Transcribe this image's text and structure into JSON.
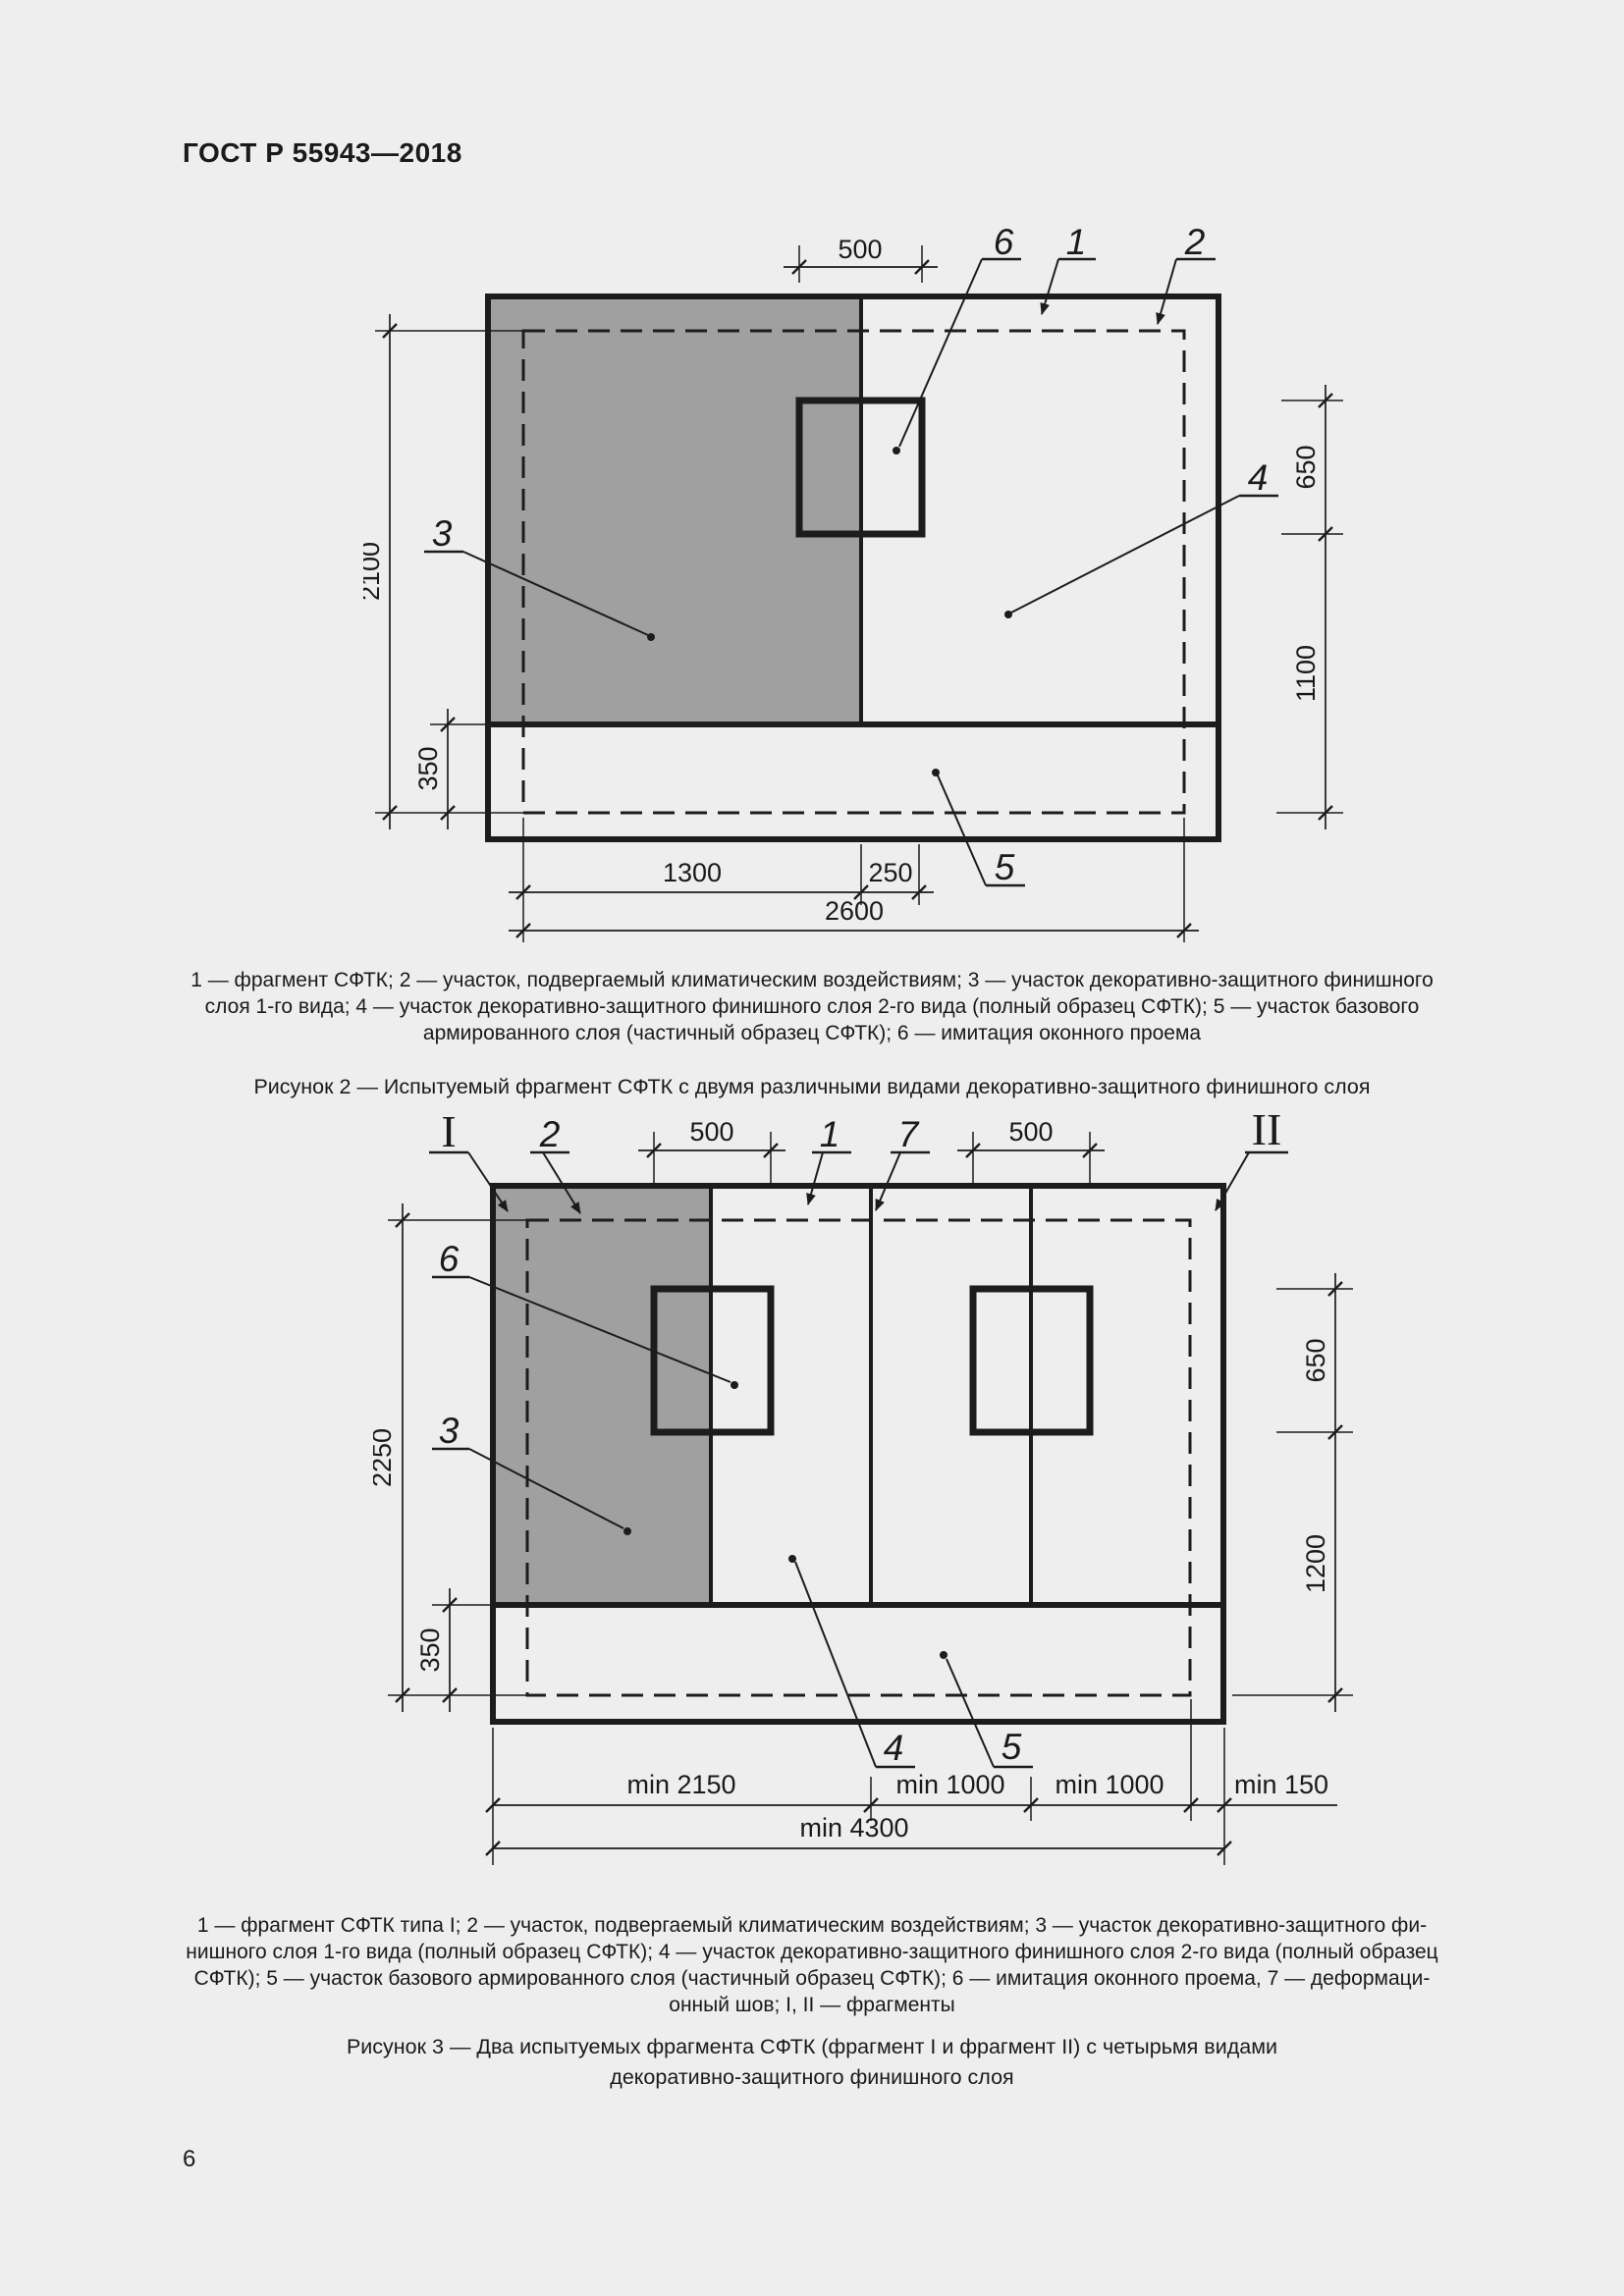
{
  "header": {
    "title": "ГОСТ Р 55943—2018"
  },
  "colors": {
    "background": "#eeeeee",
    "line": "#1c1c1c",
    "gray_fill": "#a0a0a0"
  },
  "figure2": {
    "labels": {
      "l1": "1",
      "l2": "2",
      "l3": "3",
      "l4": "4",
      "l5": "5",
      "l6": "6"
    },
    "dims": {
      "win_width": "500",
      "zone_height": "2100",
      "strip_height": "350",
      "win_height": "650",
      "below_win": "1100",
      "left_part": "1300",
      "win_offset": "250",
      "zone_width": "2600"
    },
    "legend_lines": [
      "1 — фрагмент СФТК; 2 — участок, подвергаемый климатическим воздействиям; 3 — участок декоративно-защитного финишного",
      "слоя 1-го вида; 4 — участок декоративно-защитного финишного слоя 2-го вида (полный образец СФТК); 5 — участок базового",
      "армированного слоя (частичный образец СФТК); 6 — имитация оконного проема"
    ],
    "caption": "Рисунок 2 — Испытуемый фрагмент СФТК с двумя различными видами декоративно-защитного финишного слоя"
  },
  "figure3": {
    "labels": {
      "fragment1": "I",
      "fragment2": "II",
      "l1": "1",
      "l2": "2",
      "l3": "3",
      "l4": "4",
      "l5": "5",
      "l6": "6",
      "l7": "7"
    },
    "dims": {
      "win1_width": "500",
      "win2_width": "500",
      "zone_height": "2250",
      "strip_height": "350",
      "win_height": "650",
      "below_win": "1200",
      "seg1": "min 2150",
      "seg2": "min 1000",
      "seg3": "min 1000",
      "seg4": "min 150",
      "total_width": "min 4300"
    },
    "legend_lines": [
      "1 — фрагмент СФТК типа I; 2 — участок, подвергаемый климатическим воздействиям; 3 — участок декоративно-защитного фи-",
      "нишного слоя 1-го вида (полный образец СФТК); 4 — участок декоративно-защитного финишного слоя 2-го вида (полный образец",
      "СФТК); 5 — участок базового армированного слоя (частичный образец СФТК); 6 — имитация оконного проема, 7 — деформаци-",
      "онный шов; I, II — фрагменты"
    ],
    "caption_lines": [
      "Рисунок 3 — Два испытуемых фрагмента СФТК (фрагмент I и фрагмент II) с четырьмя видами",
      "декоративно-защитного финишного слоя"
    ]
  },
  "footer": {
    "page_number": "6"
  }
}
